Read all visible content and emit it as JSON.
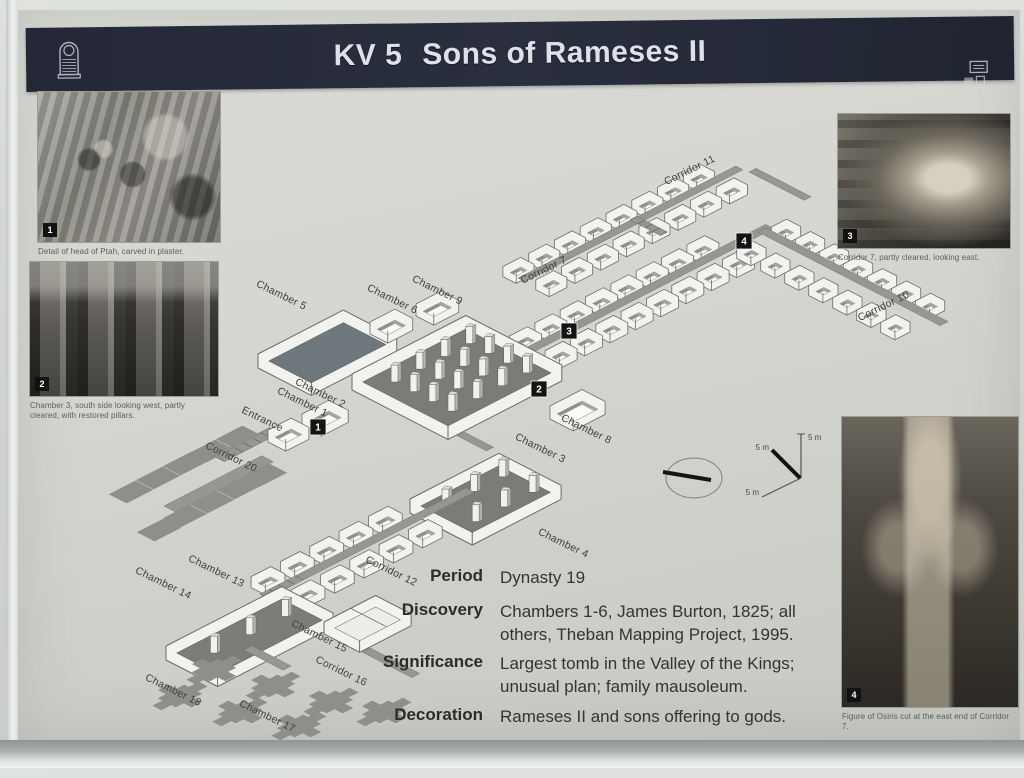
{
  "header": {
    "title_prefix": "KV 5",
    "title_main": "Sons of Rameses II",
    "logo_icon": "stela-logo-icon",
    "corner_icon": "plaque-icons"
  },
  "colors": {
    "header_bg": "#262b38",
    "paper": "#d3d4cf",
    "line": "#6b6b68",
    "corridor": "#97978f",
    "dark_floor": "#7b7b78",
    "marker": "#111111"
  },
  "photos": [
    {
      "id": "1",
      "caption": "Detail of head of Ptah, carved in plaster."
    },
    {
      "id": "2",
      "caption": "Chamber 3, south side looking west, partly cleared, with restored pillars."
    },
    {
      "id": "3",
      "caption": "Corridor 7, partly cleared, looking east."
    },
    {
      "id": "4",
      "caption": "Figure of Osiris cut at the east end of Corridor 7."
    }
  ],
  "info": {
    "rows": [
      {
        "label": "Period",
        "value": "Dynasty 19"
      },
      {
        "label": "Discovery",
        "value": "Chambers 1-6, James Burton, 1825; all others, Theban Mapping Project, 1995."
      },
      {
        "label": "Significance",
        "value": "Largest tomb in the Valley of the Kings; unusual plan; family mausoleum."
      },
      {
        "label": "Decoration",
        "value": "Rameses II and sons offering to gods."
      }
    ]
  },
  "diagram": {
    "labels": [
      {
        "text": "Corridor 11",
        "x": 673,
        "y": 163,
        "rot": -26
      },
      {
        "text": "Corridor 7",
        "x": 527,
        "y": 263,
        "rot": -26
      },
      {
        "text": "Corridor 10",
        "x": 867,
        "y": 299,
        "rot": -26
      },
      {
        "text": "Chamber 5",
        "x": 262,
        "y": 288,
        "rot": 26
      },
      {
        "text": "Chamber 6",
        "x": 373,
        "y": 292,
        "rot": 26
      },
      {
        "text": "Chamber 9",
        "x": 418,
        "y": 283,
        "rot": 26
      },
      {
        "text": "Chamber 2",
        "x": 301,
        "y": 386,
        "rot": 26
      },
      {
        "text": "Chamber 1",
        "x": 283,
        "y": 395,
        "rot": 26
      },
      {
        "text": "Entrance",
        "x": 243,
        "y": 412,
        "rot": 26
      },
      {
        "text": "Chamber 8",
        "x": 567,
        "y": 422,
        "rot": 26
      },
      {
        "text": "Chamber 3",
        "x": 521,
        "y": 441,
        "rot": 26
      },
      {
        "text": "Chamber 4",
        "x": 544,
        "y": 536,
        "rot": 26
      },
      {
        "text": "Corridor 20",
        "x": 212,
        "y": 450,
        "rot": 26
      },
      {
        "text": "Chamber 13",
        "x": 197,
        "y": 564,
        "rot": 26
      },
      {
        "text": "Chamber 14",
        "x": 144,
        "y": 576,
        "rot": 26
      },
      {
        "text": "Corridor 12",
        "x": 372,
        "y": 564,
        "rot": 26
      },
      {
        "text": "Chamber 15",
        "x": 300,
        "y": 629,
        "rot": 26
      },
      {
        "text": "Corridor 16",
        "x": 322,
        "y": 664,
        "rot": 26
      },
      {
        "text": "Chamber 18",
        "x": 154,
        "y": 683,
        "rot": 26
      },
      {
        "text": "Chamber 17",
        "x": 248,
        "y": 709,
        "rot": 26
      }
    ],
    "markers": [
      {
        "n": "1",
        "x": 300,
        "y": 417
      },
      {
        "n": "2",
        "x": 521,
        "y": 379
      },
      {
        "n": "3",
        "x": 551,
        "y": 321
      },
      {
        "n": "4",
        "x": 726,
        "y": 231
      }
    ],
    "scale_labels": [
      {
        "text": "5 m",
        "x": 790,
        "y": 430,
        "anchor": "start"
      },
      {
        "text": "5 m",
        "x": 751,
        "y": 440,
        "anchor": "end"
      },
      {
        "text": "5 m",
        "x": 741,
        "y": 485,
        "anchor": "end"
      }
    ]
  }
}
